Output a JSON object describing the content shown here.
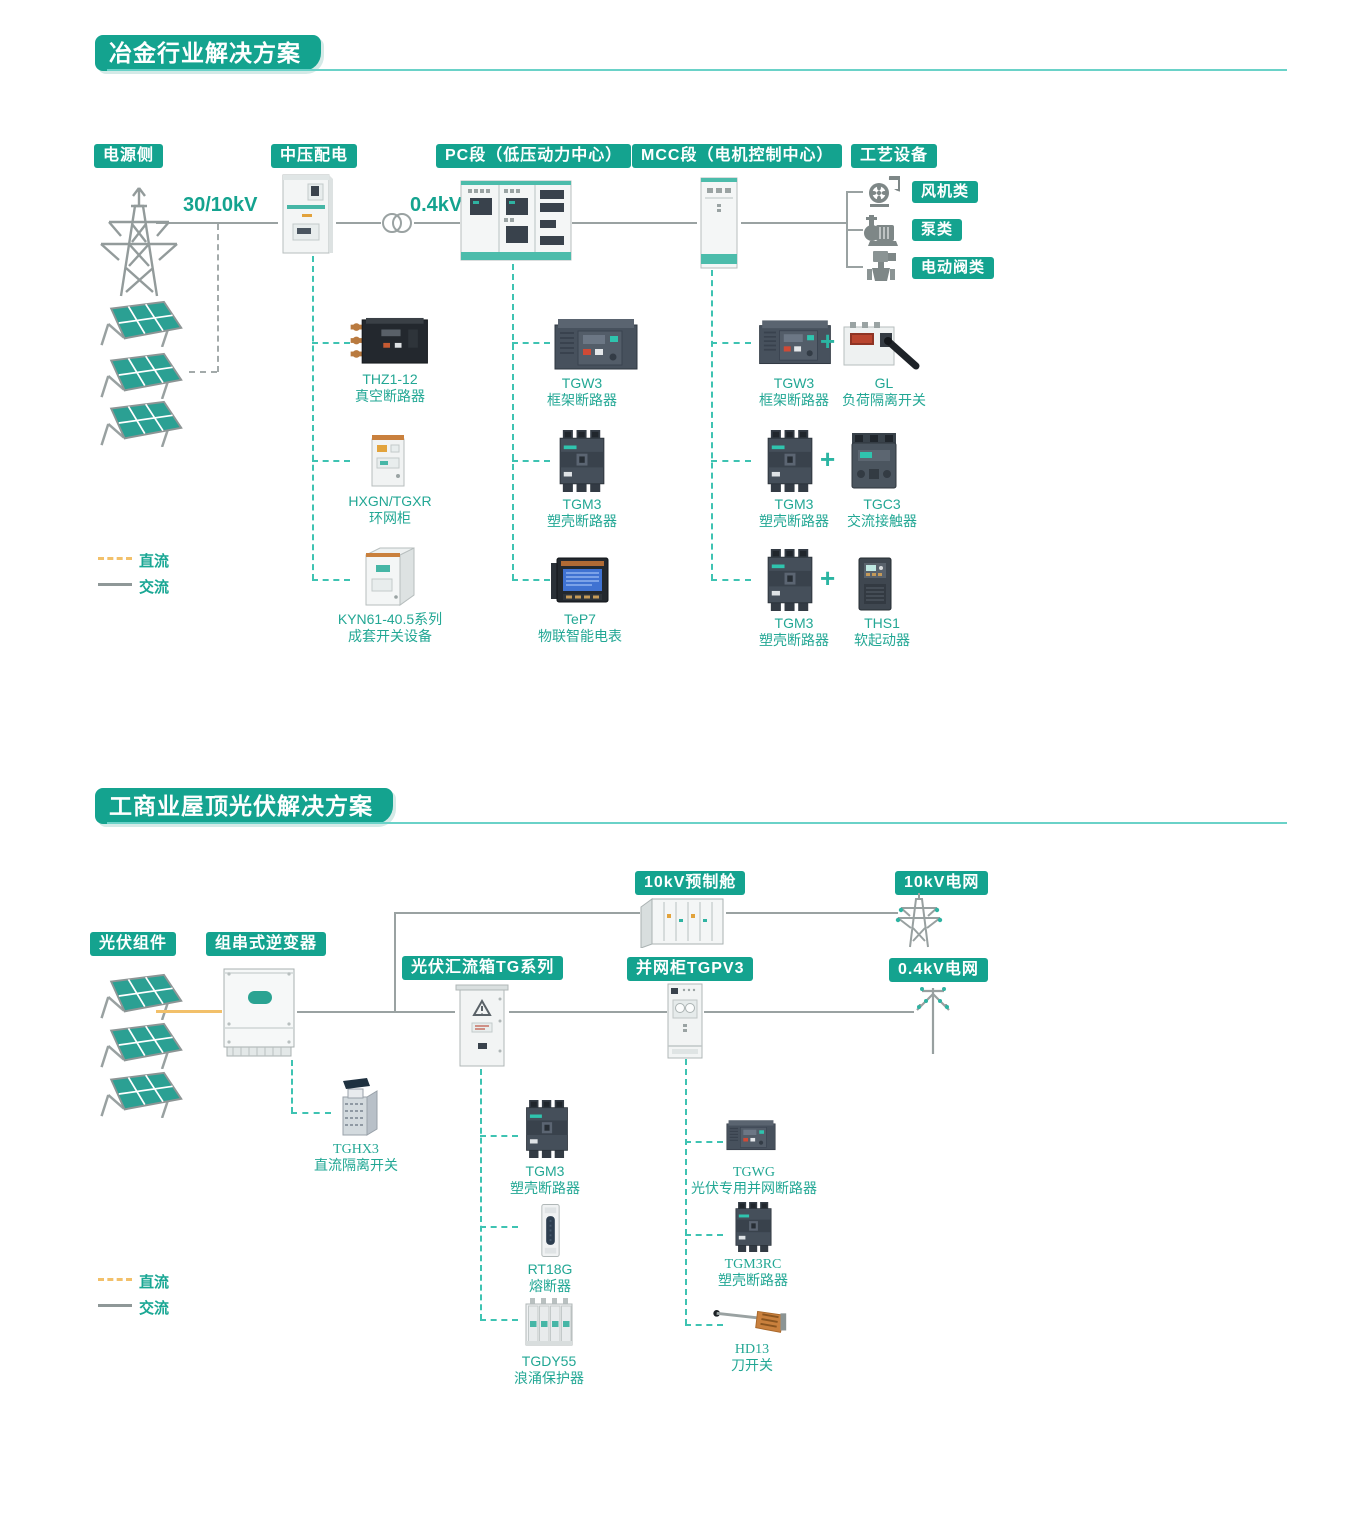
{
  "colors": {
    "teal": "#14a38f",
    "teal_dash": "#3ec3b2",
    "underline": "#6ad2c8",
    "gray_line": "#9aa2a2",
    "dc_orange": "#f2c06a"
  },
  "legend": {
    "dc": "直流",
    "ac": "交流"
  },
  "s1": {
    "title": "冶金行业解决方案",
    "labels": {
      "source": "电源侧",
      "mv": "中压配电",
      "pc": "PC段（低压动力中心）",
      "mcc": "MCC段（电机控制中心）",
      "process": "工艺设备"
    },
    "voltages": {
      "hv": "30/10kV",
      "lv": "0.4kV"
    },
    "process_types": [
      "风机类",
      "泵类",
      "电动阀类"
    ],
    "process_icons": [
      "fan-icon",
      "pump-icon",
      "valve-icon"
    ],
    "mv_products": [
      {
        "model": "THZ1-12",
        "desc": "真空断路器"
      },
      {
        "model": "HXGN/TGXR",
        "desc": "环网柜"
      },
      {
        "model": "KYN61-40.5系列",
        "desc": "成套开关设备"
      }
    ],
    "pc_products": [
      {
        "model": "TGW3",
        "desc": "框架断路器"
      },
      {
        "model": "TGM3",
        "desc": "塑壳断路器"
      },
      {
        "model": "TeP7",
        "desc": "物联智能电表"
      }
    ],
    "mcc_pairs": [
      {
        "left": {
          "model": "TGW3",
          "desc": "框架断路器"
        },
        "plus": "+",
        "right": {
          "model": "GL",
          "desc": "负荷隔离开关"
        }
      },
      {
        "left": {
          "model": "TGM3",
          "desc": "塑壳断路器"
        },
        "plus": "+",
        "right": {
          "model": "TGC3",
          "desc": "交流接触器"
        }
      },
      {
        "left": {
          "model": "TGM3",
          "desc": "塑壳断路器"
        },
        "plus": "+",
        "right": {
          "model": "THS1",
          "desc": "软起动器"
        }
      }
    ]
  },
  "s2": {
    "title": "工商业屋顶光伏解决方案",
    "labels": {
      "pv": "光伏组件",
      "inverter": "组串式逆变器",
      "combiner": "光伏汇流箱TG系列",
      "grid_cabinet": "并网柜TGPV3",
      "cabin": "10kV预制舱",
      "grid10": "10kV电网",
      "grid04": "0.4kV电网"
    },
    "inverter_products": [
      {
        "model": "TGHX3",
        "desc": "直流隔离开关"
      }
    ],
    "combiner_products": [
      {
        "model": "TGM3",
        "desc": "塑壳断路器"
      },
      {
        "model": "RT18G",
        "desc": "熔断器"
      },
      {
        "model": "TGDY55",
        "desc": "浪涌保护器"
      }
    ],
    "grid_products": [
      {
        "model": "TGWG",
        "desc": "光伏专用并网断路器"
      },
      {
        "model": "TGM3RC",
        "desc": "塑壳断路器"
      },
      {
        "model": "HD13",
        "desc": "刀开关"
      }
    ]
  }
}
